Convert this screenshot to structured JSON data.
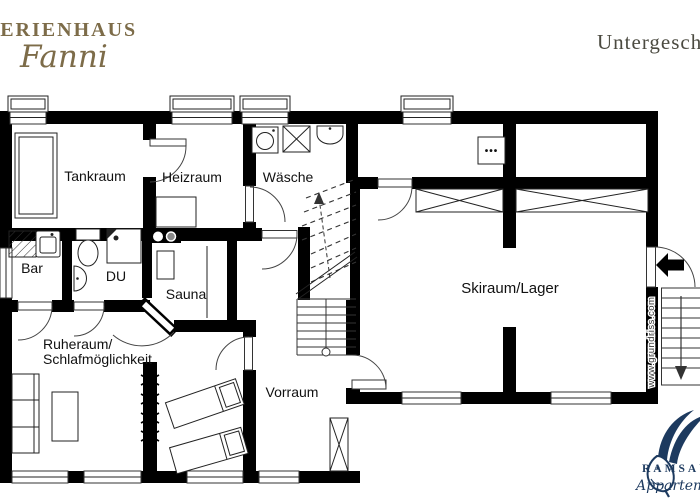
{
  "header": {
    "logo": {
      "line1": "FERIENHAUS",
      "line2": "Fanni"
    },
    "title": "Untergeschoss"
  },
  "rooms": [
    {
      "id": "tankraum",
      "label": "Tankraum"
    },
    {
      "id": "heizraum",
      "label": "Heizraum"
    },
    {
      "id": "waesche",
      "label": "Wäsche"
    },
    {
      "id": "bar",
      "label": "Bar"
    },
    {
      "id": "du",
      "label": "DU"
    },
    {
      "id": "sauna",
      "label": "Sauna"
    },
    {
      "id": "ruheraum",
      "label": "Ruheraum/",
      "label2": "Schlafmöglichkeit"
    },
    {
      "id": "vorraum",
      "label": "Vorraum"
    },
    {
      "id": "skiraum",
      "label": "Skiraum/Lager"
    }
  ],
  "annotations": {
    "watermark": "www.grundriss.com",
    "panel_dots": "•••"
  },
  "footer_logo": {
    "name": "RAMSAU",
    "subtitle": "Appartements"
  },
  "colors": {
    "wall": "#000000",
    "logo_gold": "#7d6c49",
    "logo_navy": "#1d3a5f",
    "title_gray": "#4b4a40"
  }
}
